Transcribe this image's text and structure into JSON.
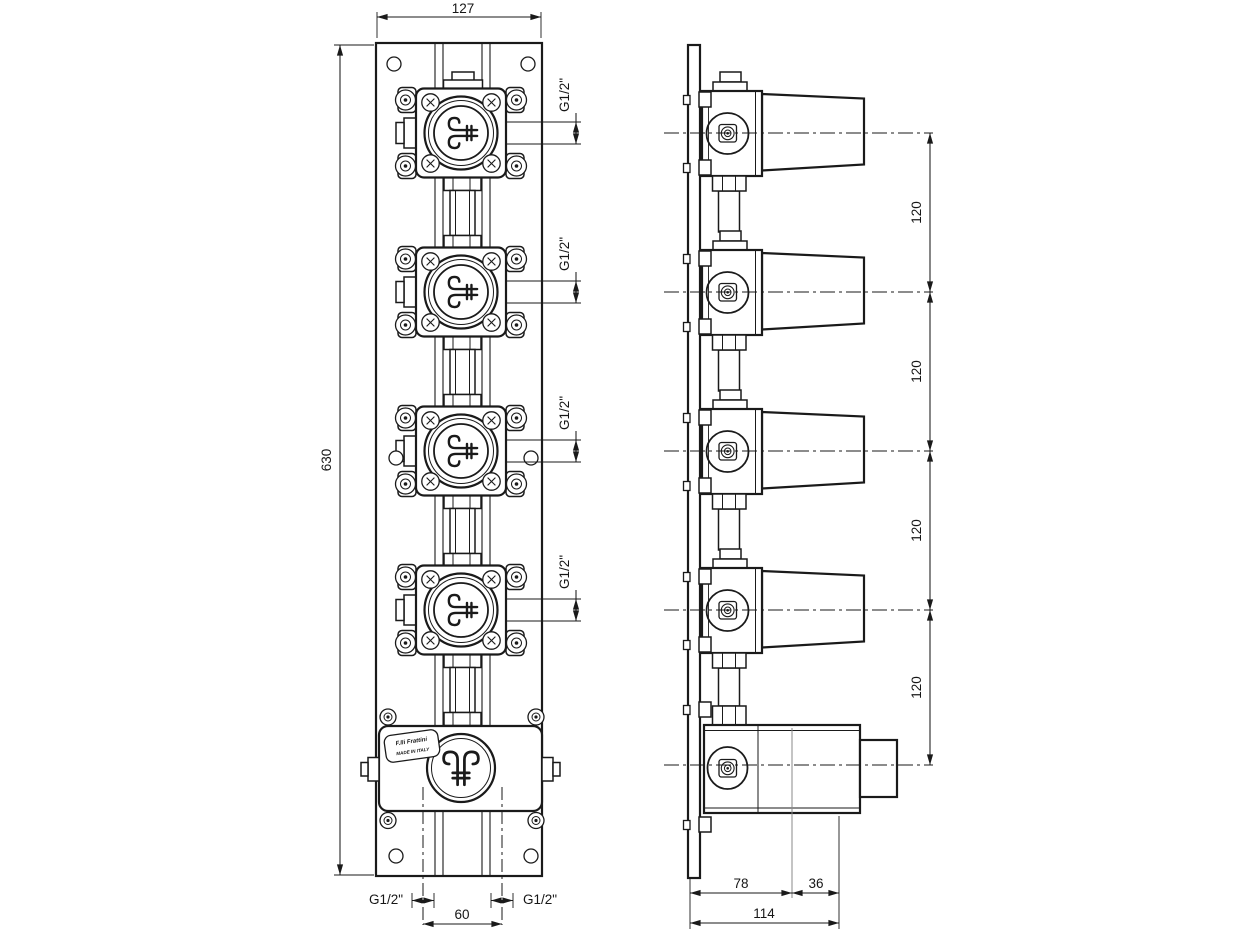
{
  "front": {
    "width_dim": "127",
    "height_dim": "630",
    "port_dims": [
      "G1/2\"",
      "G1/2\"",
      "G1/2\"",
      "G1/2\""
    ],
    "outlet_left_dim": "G1/2\"",
    "outlet_right_dim": "G1/2\"",
    "outlet_spacing_dim": "60"
  },
  "side": {
    "spacing_dims": [
      "120",
      "120",
      "120",
      "120"
    ],
    "depth_dims": {
      "body": "78",
      "trim": "36",
      "total": "114"
    }
  },
  "plate_label": {
    "brand": "F.lli Frattini",
    "origin": "MADE IN ITALY"
  },
  "line_color": "#1a1a1a"
}
